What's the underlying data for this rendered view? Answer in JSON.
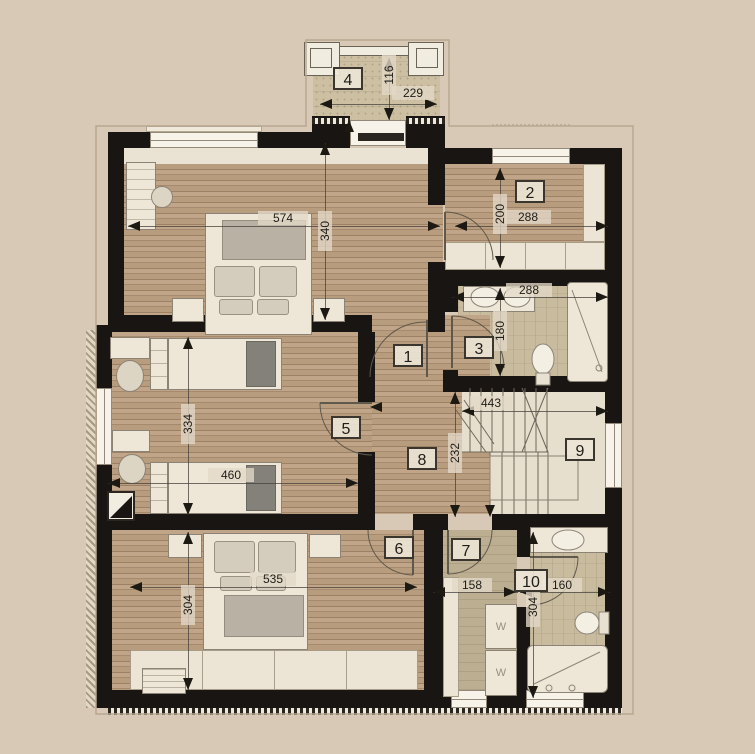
{
  "title": "floor-plan-upper-storey",
  "rooms": [
    {
      "number": "1"
    },
    {
      "number": "2"
    },
    {
      "number": "3"
    },
    {
      "number": "4"
    },
    {
      "number": "5"
    },
    {
      "number": "6"
    },
    {
      "number": "7"
    },
    {
      "number": "8"
    },
    {
      "number": "9"
    },
    {
      "number": "10"
    }
  ],
  "dims": [
    {
      "name": "bedroom1-width",
      "value": "574"
    },
    {
      "name": "bedroom1-depth",
      "value": "340"
    },
    {
      "name": "balcony-width",
      "value": "229"
    },
    {
      "name": "balcony-depth",
      "value": "116"
    },
    {
      "name": "room2-width",
      "value": "288"
    },
    {
      "name": "room2-depth",
      "value": "200"
    },
    {
      "name": "bath3-width",
      "value": "288"
    },
    {
      "name": "bath3-depth",
      "value": "180"
    },
    {
      "name": "stairhall-width",
      "value": "443"
    },
    {
      "name": "hall-depth",
      "value": "232"
    },
    {
      "name": "room5-depth",
      "value": "334"
    },
    {
      "name": "room5-width",
      "value": "460"
    },
    {
      "name": "bedroom6-width",
      "value": "535"
    },
    {
      "name": "bedroom6-depth",
      "value": "304"
    },
    {
      "name": "room7-width",
      "value": "158"
    },
    {
      "name": "bath10-width",
      "value": "160"
    },
    {
      "name": "bath10-depth",
      "value": "304"
    }
  ],
  "washers": [
    "W",
    "W"
  ],
  "colors": {
    "background": "#d8c8b6",
    "wall": "#181512",
    "wood_floor": "#b79c7f",
    "bath_tile": "#c8bb9e",
    "stair_floor": "#e7dfcd"
  }
}
